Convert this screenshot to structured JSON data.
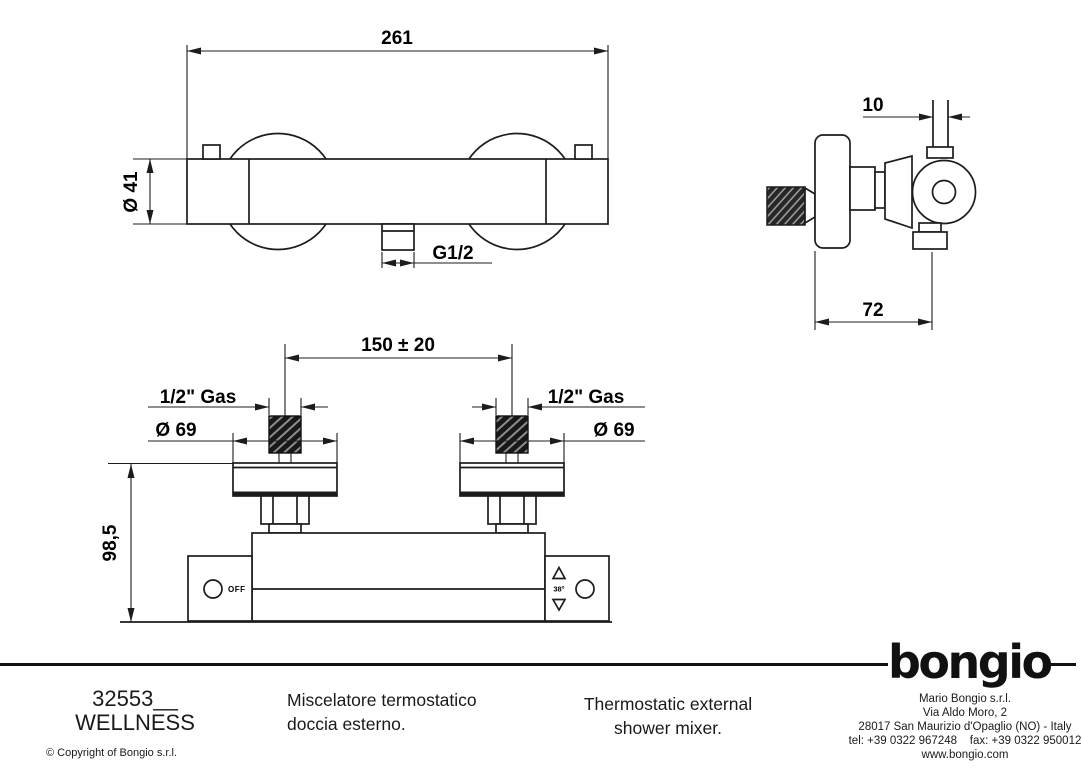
{
  "colors": {
    "ink": "#1c1c1c",
    "paper": "#ffffff"
  },
  "drawing": {
    "front_view": {
      "width_dim": "261",
      "diameter_dim": "Ø 41",
      "outlet_dim": "G1/2"
    },
    "side_view": {
      "pipe_dim": "10",
      "depth_dim": "72"
    },
    "install_view": {
      "centers_dim": "150 ± 20",
      "gas_left": "1/2\" Gas",
      "gas_right": "1/2\" Gas",
      "dia_left": "Ø 69",
      "dia_right": "Ø 69",
      "height_dim": "98,5",
      "off_label": "OFF",
      "temp_label": "38°"
    }
  },
  "title_block": {
    "article_code": "32553__",
    "series": "WELLNESS",
    "copyright": "© Copyright of Bongio s.r.l.",
    "description_it_line1": "Miscelatore termostatico",
    "description_it_line2": "doccia esterno.",
    "description_en_line1": "Thermostatic external",
    "description_en_line2": "shower mixer.",
    "logo_text": "bongio",
    "company": [
      "Mario Bongio s.r.l.",
      "Via Aldo Moro, 2",
      "28017 San Maurizio d'Opaglio (NO) - Italy",
      "tel: +39 0322 967248    fax: +39 0322 950012",
      "www.bongio.com"
    ]
  }
}
